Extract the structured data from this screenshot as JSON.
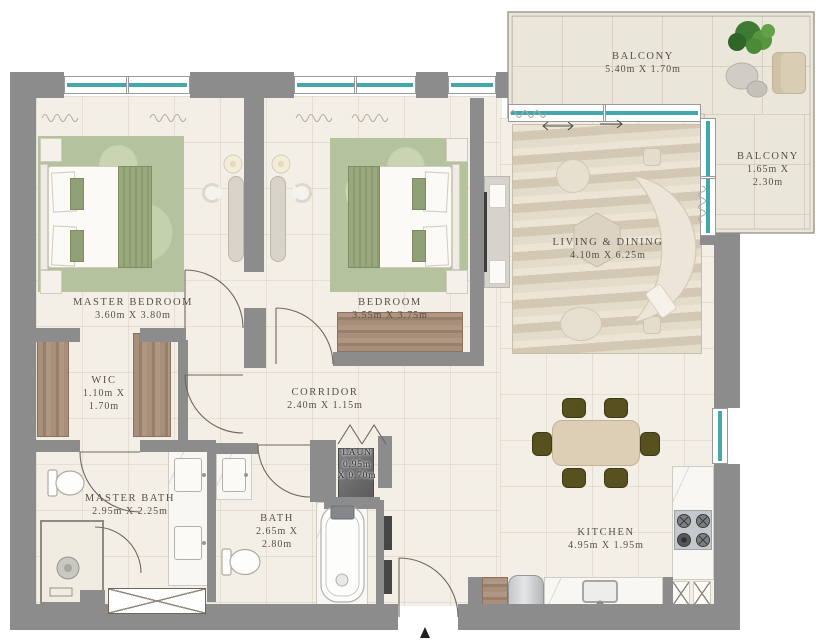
{
  "plan": {
    "title": "2-bedroom apartment floor plan",
    "rooms": [
      {
        "id": "master-bedroom",
        "name": "MASTER BEDROOM",
        "dims": "3.60m X 3.80m"
      },
      {
        "id": "bedroom",
        "name": "BEDROOM",
        "dims": "3.55m X 3.75m"
      },
      {
        "id": "living-dining",
        "name": "LIVING & DINING",
        "dims": "4.10m X 6.25m"
      },
      {
        "id": "balcony-top",
        "name": "BALCONY",
        "dims": "5.40m X 1.70m"
      },
      {
        "id": "balcony-right",
        "name": "BALCONY",
        "dims": "1.65m X 2.30m"
      },
      {
        "id": "wic",
        "name": "WIC",
        "dims": "1.10m X\n1.70m"
      },
      {
        "id": "corridor",
        "name": "CORRIDOR",
        "dims": "2.40m X 1.15m"
      },
      {
        "id": "master-bath",
        "name": "MASTER BATH",
        "dims": "2.95m X 2.25m"
      },
      {
        "id": "bath",
        "name": "BATH",
        "dims": "2.65m X\n2.80m"
      },
      {
        "id": "laundry",
        "name": "LAUN",
        "dims": "0.95m\nX 0.70m"
      },
      {
        "id": "kitchen",
        "name": "KITCHEN",
        "dims": "4.95m X 1.95m"
      }
    ],
    "colors": {
      "wall": "#8c8c8c",
      "floor": "#f4efe6",
      "balcony_floor": "#ebe6da",
      "window_glass": "#43a7ae",
      "rug_green": "#b5c29e",
      "rug_living": "#d7cebd",
      "wood": "#a78f7c",
      "dining_chair": "#57511f",
      "label_text": "#55504a"
    }
  }
}
